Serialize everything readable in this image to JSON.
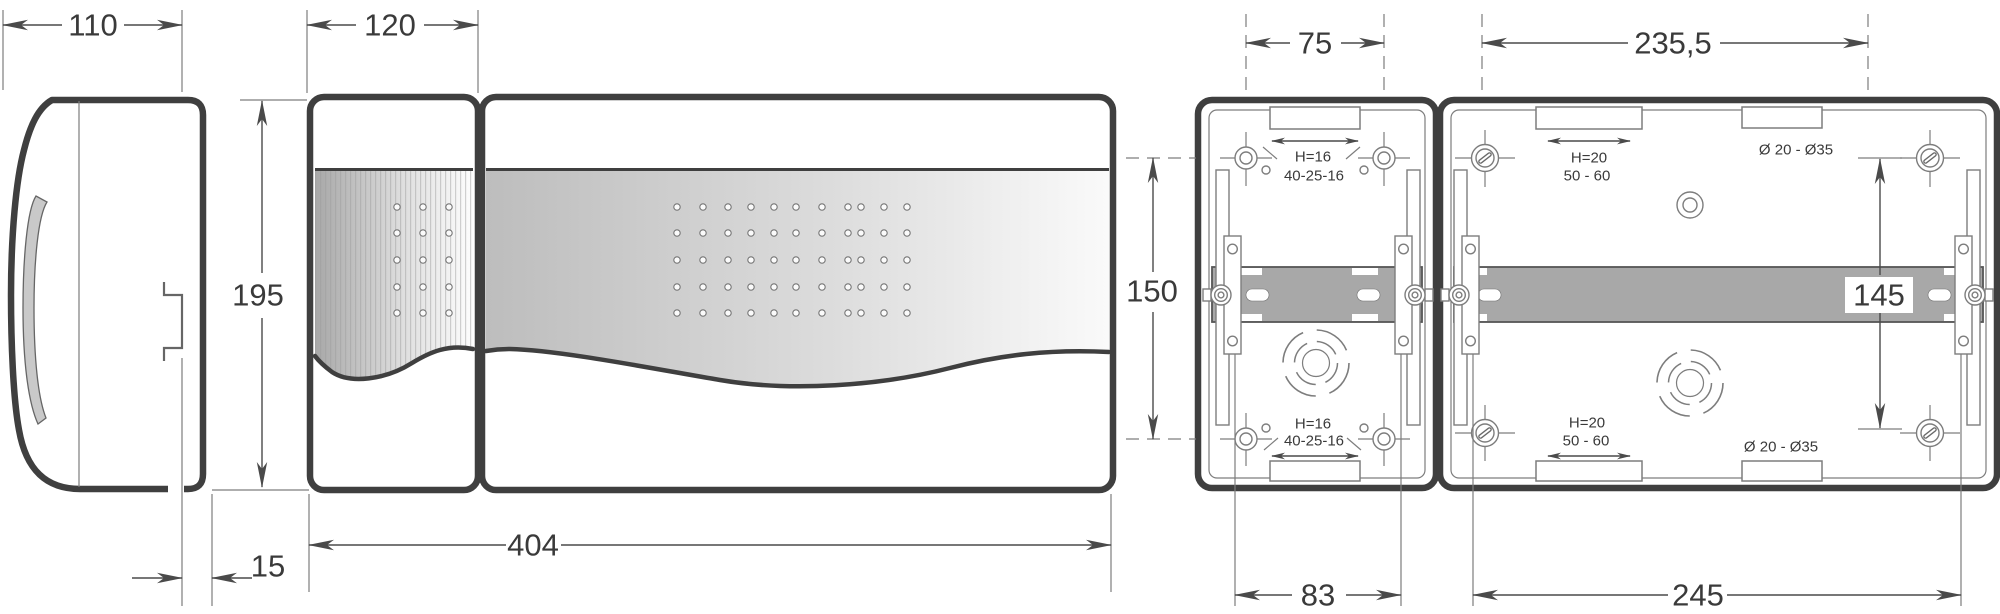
{
  "drawing_type": "enclosure-dimension-drawing",
  "units": "mm",
  "colors": {
    "outline": "#3f3f3f",
    "thin": "#7d7d7d",
    "dim": "#4a4a4a",
    "text": "#3a3a3a",
    "rail": "#a8a8a8",
    "handle": "#c9c9c9"
  },
  "dimensions": {
    "side_depth": "110",
    "door_panel_width": "120",
    "height": "195",
    "rear_offset": "15",
    "front_width": "404",
    "small_hole_spacing_x": "75",
    "large_hole_spacing_x": "235,5",
    "small_hole_spacing_y": "150",
    "large_hole_spacing_y": "145",
    "small_base_width": "83",
    "large_base_width": "245"
  },
  "annotations": {
    "small_knockout_height": "H=16",
    "small_knockout_sizes": "40-25-16",
    "large_knockout_height": "H=20",
    "large_knockout_sizes": "50 - 60",
    "large_gland_diameters": "Ø 20 - Ø35"
  },
  "perforations": {
    "left_panel": {
      "cols": [
        397,
        423,
        449
      ],
      "rows": [
        207,
        233,
        260,
        287,
        313
      ]
    },
    "wide_panel": {
      "cols": [
        677,
        703,
        728,
        751,
        774,
        796,
        822,
        848,
        861,
        884,
        907
      ],
      "rows": [
        207,
        233,
        260,
        287,
        313
      ]
    }
  }
}
